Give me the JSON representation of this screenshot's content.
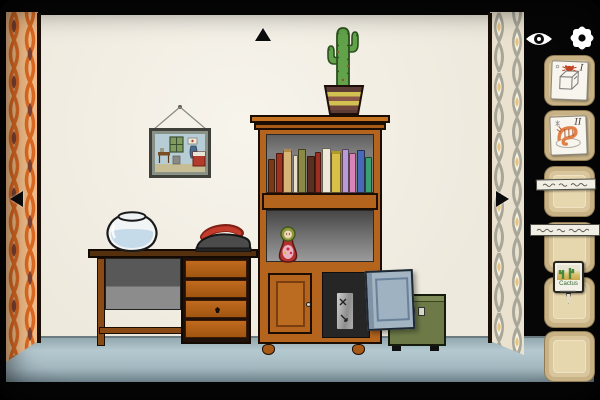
{
  "hud": {
    "icons": [
      {
        "name": "eye-icon"
      },
      {
        "name": "gear-icon"
      }
    ]
  },
  "navigation": {
    "arrows": [
      {
        "name": "up-arrow",
        "direction": "up"
      },
      {
        "name": "left-arrow",
        "direction": "left"
      },
      {
        "name": "right-arrow",
        "direction": "right"
      }
    ]
  },
  "inventory": {
    "slots": [
      {
        "position": 1,
        "item": "paper-card-cube-with-crab-sketch",
        "numeral": "I"
      },
      {
        "position": 2,
        "item": "paper-card-shrimp-sketch",
        "numeral": "II"
      },
      {
        "position": 3,
        "item": "empty",
        "note": "illegible-handwritten-strip"
      },
      {
        "position": 4,
        "item": "empty",
        "note": "illegible-handwritten-strip"
      },
      {
        "position": 5,
        "item": "cactus-plant-tag",
        "label": "Cactus"
      },
      {
        "position": 6,
        "item": "empty"
      }
    ]
  },
  "scene": {
    "room_objects": [
      "framed-picture",
      "potted-cactus",
      "bookcase",
      "books",
      "matryoshka-doll",
      "cabinet-door-closed",
      "cabinet-door-open",
      "metal-plate",
      "green-safe",
      "desk",
      "desk-drawers",
      "fishbowl",
      "iron"
    ]
  },
  "colors": {
    "wall": "#f2efe7",
    "floor": "#a9bec6",
    "wood": "#b4641c",
    "wallpaper_left_orange": "#dd6a22",
    "wallpaper_left_peach": "#f2bd88",
    "wallpaper_left_brown": "#7c4434",
    "wallpaper_right_cream": "#eae2cf",
    "wallpaper_right_gray": "#a8a698",
    "wallpaper_right_yellow": "#e5c47c",
    "safe_green": "#6d7a48",
    "open_door_blue": "#a3b5c3",
    "iron_red": "#c23b2b",
    "inventory_slot_tan": "#d7c398"
  }
}
